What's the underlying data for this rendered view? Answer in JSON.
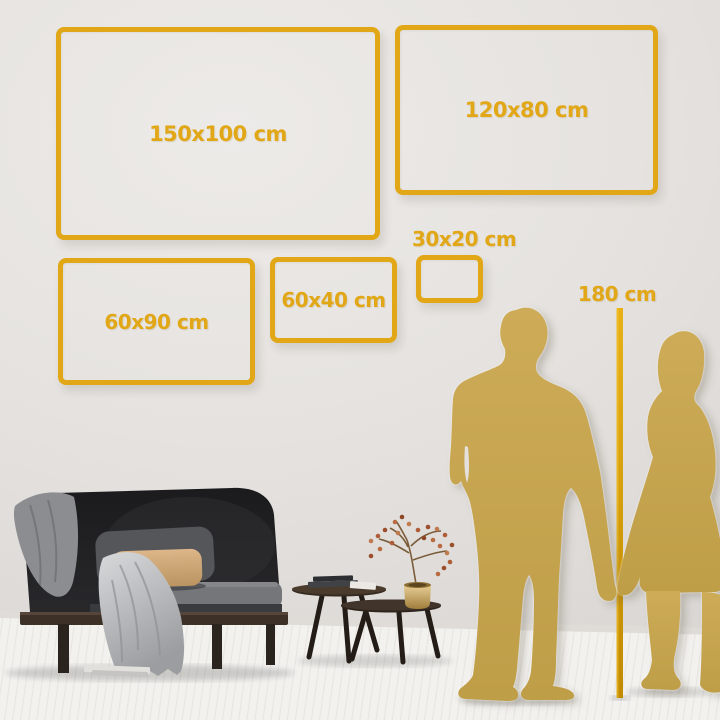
{
  "title": "Wall art size comparison guide",
  "size_guide": {
    "frames": [
      {
        "label": "150x100 cm",
        "width_cm": 150,
        "height_cm": 100
      },
      {
        "label": "120x80 cm",
        "width_cm": 120,
        "height_cm": 80
      },
      {
        "label": "60x90 cm",
        "width_cm": 60,
        "height_cm": 90
      },
      {
        "label": "60x40 cm",
        "width_cm": 60,
        "height_cm": 40
      },
      {
        "label": "30x20 cm",
        "width_cm": 30,
        "height_cm": 20
      }
    ],
    "height_reference": {
      "label": "180 cm",
      "height_cm": 180
    }
  },
  "colors": {
    "accent_gold": "#e2a716",
    "pole_gold": "#cf9404",
    "silhouette_gold": "#c6a44f",
    "wall_grey": "#e5e2df",
    "floor_white": "#f4f3f1"
  },
  "scene_objects": {
    "figures": [
      "man-silhouette",
      "woman-silhouette"
    ],
    "furniture": [
      "dark-velvet-sofa",
      "grey-blanket",
      "throw-blanket",
      "dark-pillow",
      "beige-pillow",
      "nesting-coffee-tables",
      "book-stack",
      "brass-vase",
      "dried-flower-branch",
      "floor-books"
    ]
  }
}
